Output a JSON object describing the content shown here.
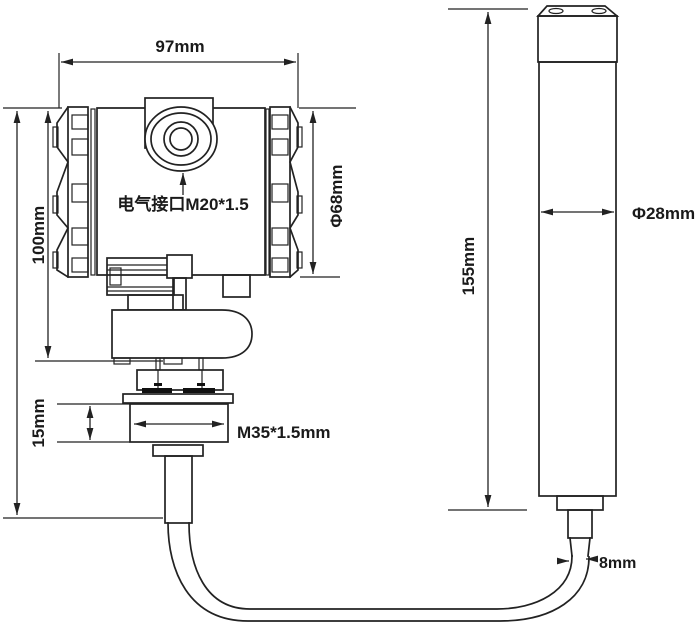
{
  "diagram": {
    "type": "technical-dimension-drawing",
    "units": "mm",
    "colors": {
      "line": "#222222",
      "text": "#1a1a1a",
      "background": "#ffffff"
    },
    "transmitter": {
      "overall_width_label": "97mm",
      "head_height_label": "100mm",
      "head_diameter_label": "Φ68mm",
      "electrical_port_label": "电气接口M20*1.5",
      "thread_label": "M35*1.5mm",
      "thread_height_label": "15mm"
    },
    "probe": {
      "length_label": "155mm",
      "diameter_label": "Φ28mm",
      "cable_diameter_label": "8mm"
    }
  }
}
